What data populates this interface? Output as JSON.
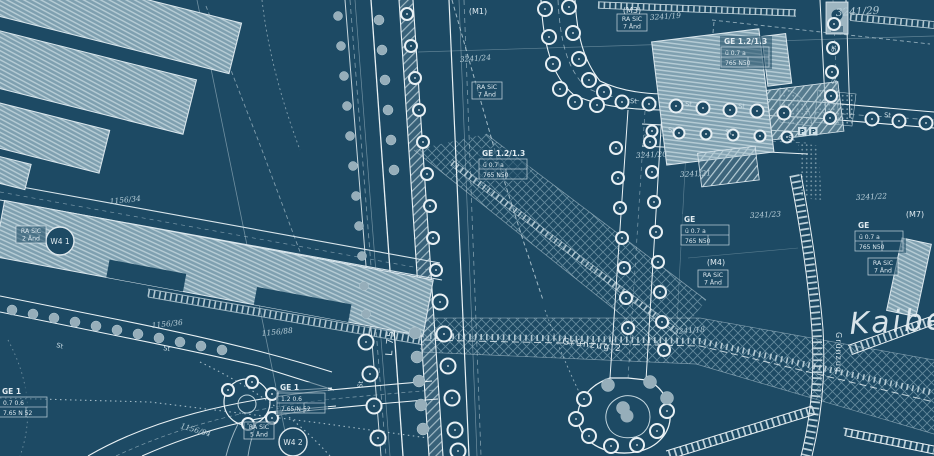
{
  "map": {
    "place_name": "Kaiber",
    "corridor_label": "Grünzug 2",
    "corridor_label_vertical": "Grünzug",
    "road_number_label": "L 75",
    "street_marker_text": "St",
    "parking_marker_text": "P",
    "zone_markers": [
      {
        "text": "(M1)"
      },
      {
        "text": "(M3)"
      },
      {
        "text": "(M4)"
      },
      {
        "text": "(M7)"
      }
    ],
    "housing_markers": [
      {
        "text": "W4 1"
      },
      {
        "text": "W4 2"
      }
    ],
    "amendment_boxes": [
      {
        "line1": "RA SiC",
        "line2": "7 Änd"
      },
      {
        "line1": "RA SiC",
        "line2": "7 Änd"
      },
      {
        "line1": "RA SiC",
        "line2": "7 Änd"
      },
      {
        "line1": "RA SiC",
        "line2": "7 Änd"
      },
      {
        "line1": "RA SiC",
        "line2": "2 Änd"
      },
      {
        "line1": "RA SiC",
        "line2": "5 Änd"
      }
    ],
    "zoning_boxes": [
      {
        "line1": "GE 1.2/1.3",
        "line2": "ü 0.7 a",
        "line3": "765 N50"
      },
      {
        "line1": "GE 1.2/1.3",
        "line2": "ü 0.7 a",
        "line3": "765 N50"
      },
      {
        "line1": "GE",
        "line2": "ü 0.7 a",
        "line3": "765 N50"
      },
      {
        "line1": "GE",
        "line2": "ü 0.7 a",
        "line3": "765 N50"
      },
      {
        "line1": "GE 1",
        "line2": "1.2 0.6",
        "line3": "7.65/N-52"
      },
      {
        "line1": "GE 1",
        "line2": "0.7 0.6",
        "line3": "7.65 N 52"
      }
    ],
    "parcel_numbers": [
      {
        "text": "3241/19"
      },
      {
        "text": "3241/24"
      },
      {
        "text": "3241/29"
      },
      {
        "text": "3241/20"
      },
      {
        "text": "3241/21"
      },
      {
        "text": "3241/23"
      },
      {
        "text": "3241/22"
      },
      {
        "text": "3241/18"
      },
      {
        "text": "1156/34"
      },
      {
        "text": "1156/36"
      },
      {
        "text": "1156/88"
      },
      {
        "text": "1156/84"
      }
    ],
    "colors": {
      "background": "#1d4a64",
      "line_bright": "#eaf2f5",
      "line_light": "#c3d6de",
      "line_mid": "#7fa3b4",
      "building_fill": "#7fa0b0",
      "building_stripe": "#b7cdd6",
      "tree_solid": "#96aeba",
      "text_light": "#d9e6ec"
    }
  }
}
